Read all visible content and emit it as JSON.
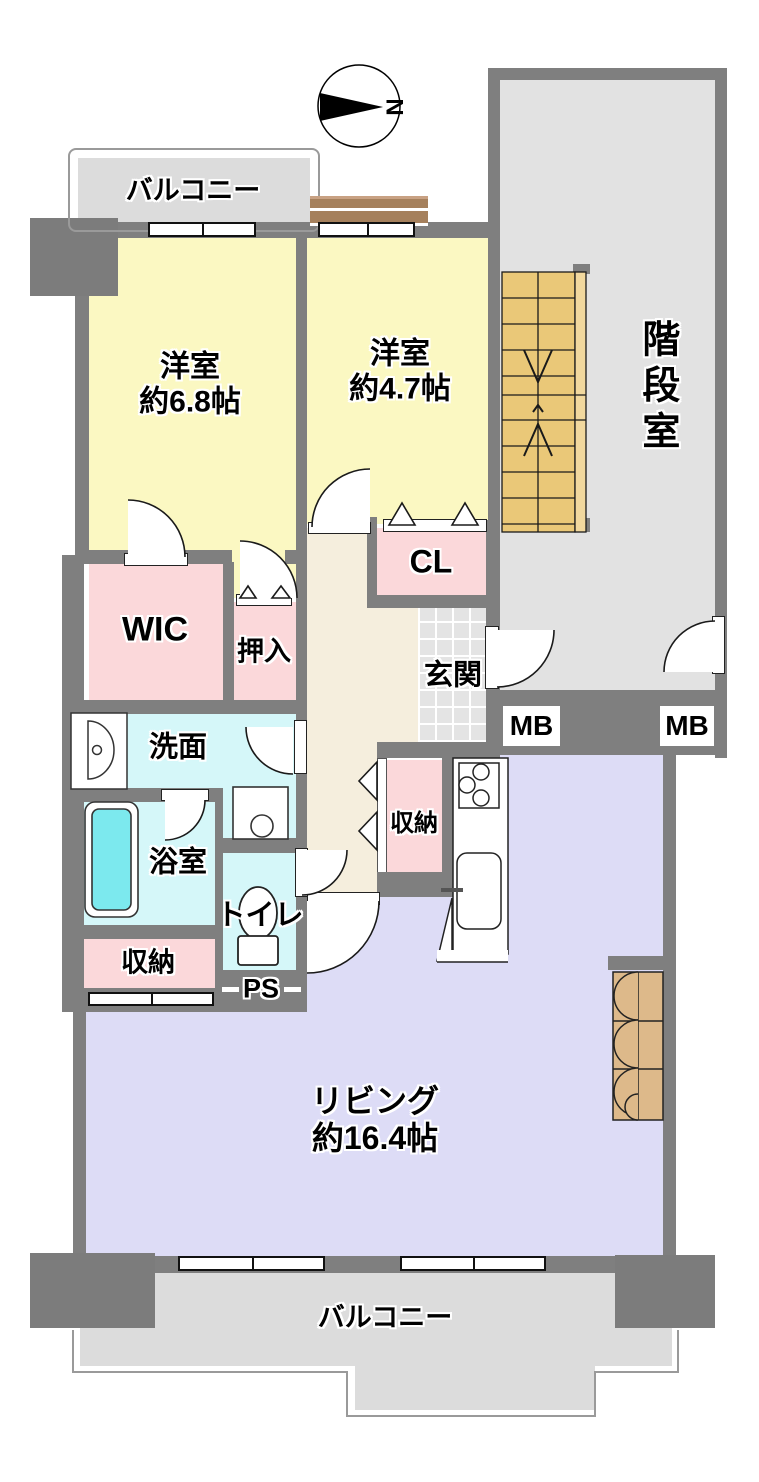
{
  "compass": {
    "label": "N"
  },
  "rooms": {
    "balcony_top": {
      "label": "バルコニー"
    },
    "bedroom1": {
      "label": "洋室",
      "size": "約6.8帖"
    },
    "bedroom2": {
      "label": "洋室",
      "size": "約4.7帖"
    },
    "stairwell": {
      "label": "階段室"
    },
    "closet_cl": {
      "label": "CL"
    },
    "wic": {
      "label": "WIC"
    },
    "oshiire": {
      "label": "押入"
    },
    "genkan": {
      "label": "玄関"
    },
    "meter_box_left": {
      "label": "MB"
    },
    "meter_box_right": {
      "label": "MB"
    },
    "washroom": {
      "label": "洗面"
    },
    "bathroom": {
      "label": "浴室"
    },
    "toilet": {
      "label": "トイレ"
    },
    "storage_bath": {
      "label": "収納"
    },
    "pipe_space": {
      "label": "PS"
    },
    "storage_kitchen": {
      "label": "収納"
    },
    "living": {
      "label": "リビング",
      "size": "約16.4帖"
    },
    "balcony_bottom": {
      "label": "バルコニー"
    }
  },
  "colors": {
    "wall": "#7f7f7f",
    "balcony": "#dcdcdc",
    "bedroom_yellow": "#fbf8c2",
    "closet_pink": "#fbd8da",
    "wet_cyan": "#d5f7f9",
    "tub_cyan": "#7ce9ee",
    "living_lavender": "#dddcf6",
    "hall_beige": "#f5eedd",
    "stairs_tan": "#eac878",
    "closet_wood": "#ddb98a"
  }
}
